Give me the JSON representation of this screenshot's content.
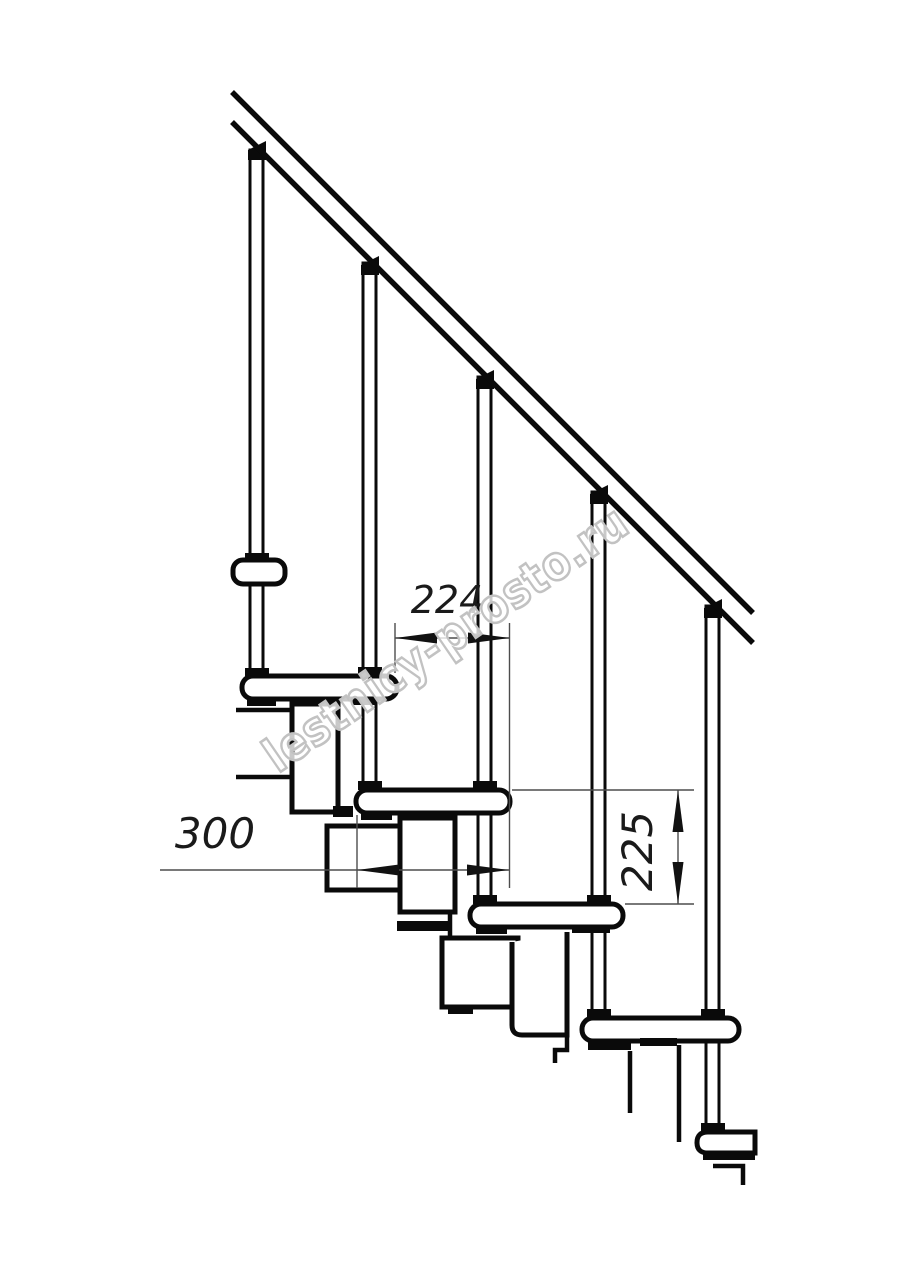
{
  "drawing": {
    "type": "staircase-side-view-technical-drawing",
    "background": "#ffffff",
    "ink_color": "#0a0a0a",
    "dim_line_color": "#4d4d4d",
    "dim_text_color": "#1a1a1a"
  },
  "dimensions": {
    "step_run_horizontal": {
      "value": "224"
    },
    "tread_depth_horizontal": {
      "value": "300"
    },
    "step_rise_vertical": {
      "value": "225"
    }
  },
  "watermark": {
    "text": "lestnicy-prosto.ru",
    "outline_color": "#c2c2c2",
    "fill_color": "#ffffff"
  }
}
